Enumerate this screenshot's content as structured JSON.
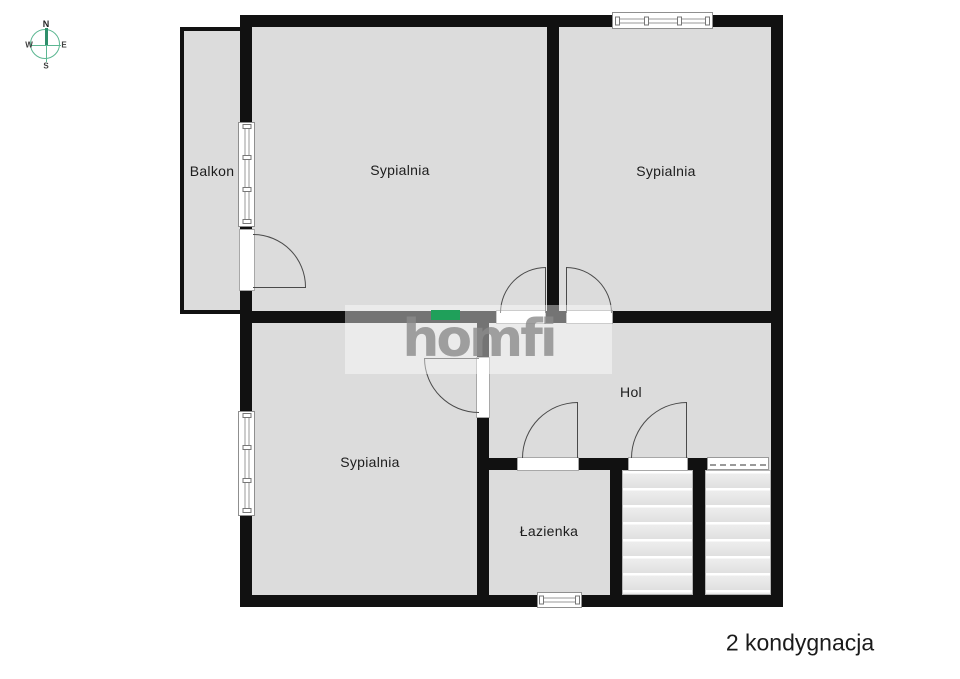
{
  "caption": "2 kondygnacja",
  "logo": {
    "text": "homfi"
  },
  "compass": {
    "n": "N",
    "e": "E",
    "s": "S",
    "w": "W"
  },
  "rooms": {
    "balkon": "Balkon",
    "sypialnia_top_left": "Sypialnia",
    "sypialnia_top_right": "Sypialnia",
    "sypialnia_bottom": "Sypialnia",
    "hol": "Hol",
    "lazienka": "Łazienka"
  },
  "colors": {
    "wall": "#111111",
    "floor": "#dcdcdc",
    "accent_green": "#1fa05a",
    "logo_gray": "#8b8b8b",
    "compass_green": "#5cb792"
  }
}
